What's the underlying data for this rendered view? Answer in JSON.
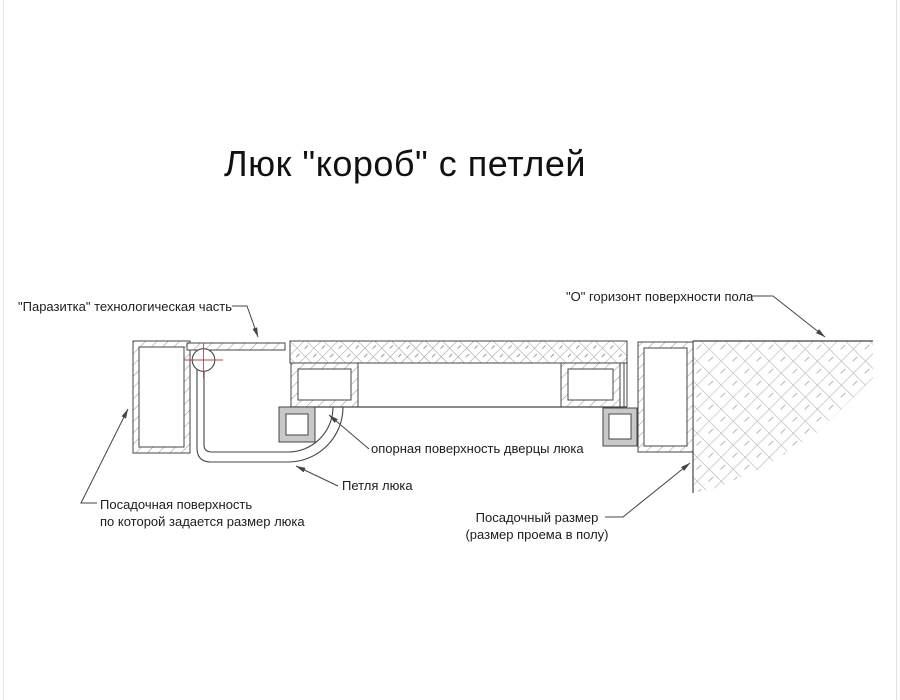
{
  "title": "Люк \"короб\" с петлей",
  "labels": {
    "parasitic_part": "\"Паразитка\" технологическая часть",
    "floor_horizon": "\"О\" горизонт поверхности пола",
    "door_support_surface": "опорная поверхность дверцы люка",
    "hatch_hinge": "Петля люка",
    "seating_surface_line1": "Посадочная поверхность",
    "seating_surface_line2": "по которой задается размер люка",
    "seating_size_line1": "Посадочный размер",
    "seating_size_line2": "(размер проема в полу)"
  },
  "colors": {
    "background": "#ffffff",
    "drawing_line": "#454545",
    "border_hatch": "#9a9a9a",
    "floor_hatch": "#b6b6b6",
    "centerline_red": "#a0524c",
    "bracket_gray": "#c9c9c9",
    "text": "#1c1c1c",
    "edge_line": "#e0e0e0"
  }
}
